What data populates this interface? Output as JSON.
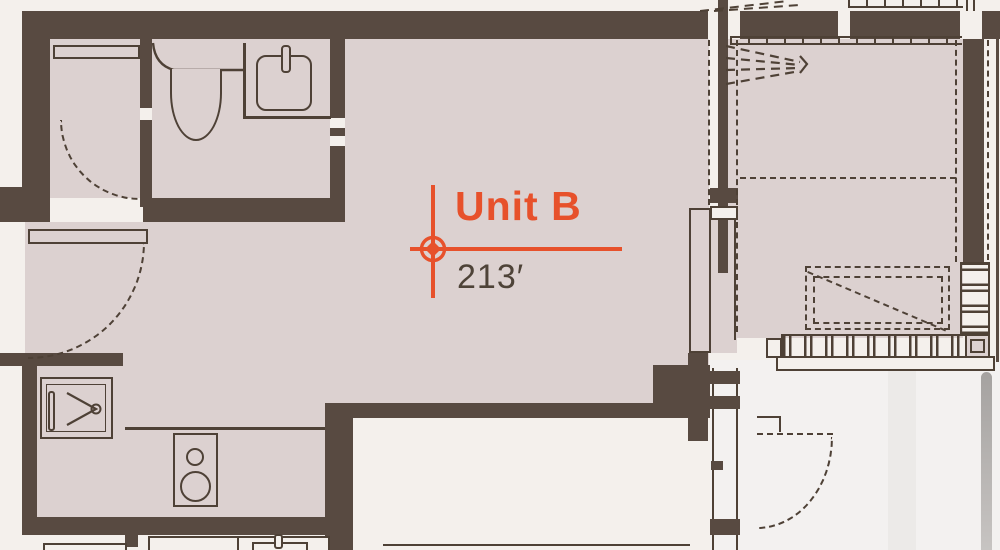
{
  "annotation": {
    "unit_name": "Unit B",
    "area": "213′"
  },
  "colors": {
    "floor": "#dcd1d0",
    "wall": "#584a41",
    "outside": "#f4f0ec",
    "outside_right": "#f3f1f0",
    "outside_stripe": "#eceae8",
    "line": "#4e4136",
    "accent": "#e7512b",
    "area_text": "#4e4338",
    "gray_bar_top": "#a5a2a0",
    "gray_bar_bottom": "#c7c4c2"
  },
  "fixtures": {
    "bathroom": [
      "toilet",
      "sink",
      "vanity-counter"
    ],
    "closet": [
      "shelf",
      "door-swing"
    ],
    "kitchen": [
      "kitchen-sink",
      "cooktop",
      "counter-edge"
    ],
    "entry": [
      "entry-door",
      "door-swing"
    ],
    "bedroom": [
      "wardrobe-dashed",
      "louver-window",
      "overhead-dashed"
    ],
    "exterior": [
      "balcony-door-swing",
      "glass-wall"
    ]
  }
}
